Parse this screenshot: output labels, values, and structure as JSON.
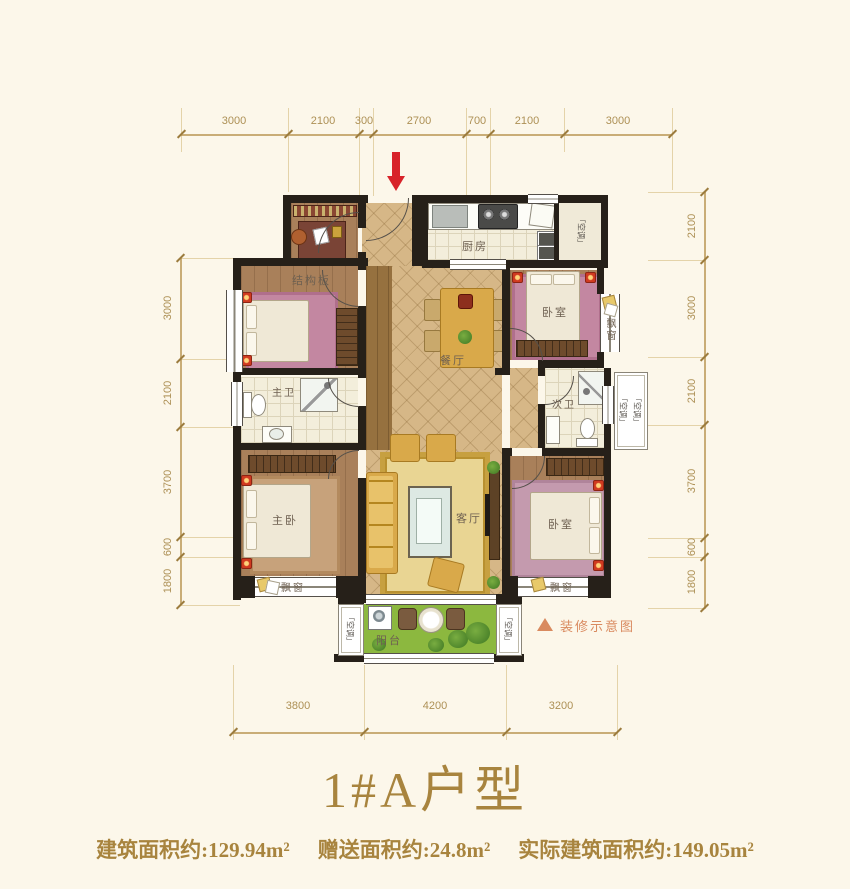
{
  "title": "1#A户型",
  "area_line": {
    "built": "建筑面积约:129.94m²",
    "bonus": "赠送面积约:24.8m²",
    "actual": "实际建筑面积约:149.05m²"
  },
  "legend": {
    "marker_label": "装修示意图"
  },
  "rooms": {
    "kitchen": "厨房",
    "dining": "餐厅",
    "living": "客厅",
    "master_bedroom": "主卧",
    "bedroom_top_right": "卧室",
    "bedroom_bottom_right": "卧室",
    "master_bath": "主卫",
    "second_bath": "次卫",
    "balcony": "阳台",
    "structural_slab": "结构板",
    "bay_window": "飘窗",
    "ac_platform": "「空调」"
  },
  "dimensions": {
    "top": [
      "3000",
      "2100",
      "300",
      "2700",
      "700",
      "2100",
      "3000"
    ],
    "left": [
      "3000",
      "2100",
      "3700",
      "600",
      "1800"
    ],
    "right": [
      "2100",
      "3000",
      "2100",
      "3700",
      "600",
      "1800"
    ],
    "bottom": [
      "3800",
      "4200",
      "3200"
    ]
  },
  "colors": {
    "accent_red": "#d8232a",
    "gold_text": "#a8843e",
    "dim_text": "#ad9055",
    "legend_orange": "#d98a5f",
    "wall": "#262019",
    "balcony_green": "#8cb83f"
  }
}
